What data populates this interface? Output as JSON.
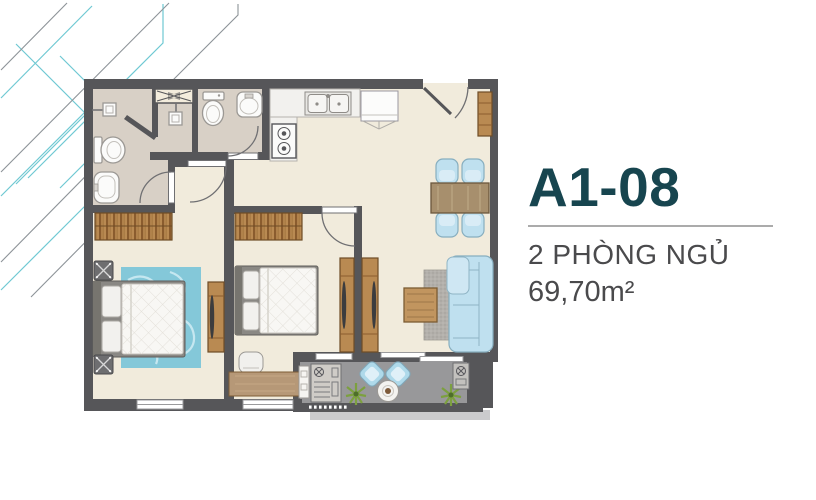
{
  "unit": {
    "code": "A1-08",
    "bedrooms_label": "2 PHÒNG NGỦ",
    "area_label": "69,70m²"
  },
  "palette": {
    "accent_teal": "#17454f",
    "text_gray": "#4a4a4c",
    "divider_gray": "#ababab",
    "wall": "#565659",
    "floor_cream": "#f1ebdc",
    "floor_taupe": "#d8d0c6",
    "balcony_floor": "#98989a",
    "slab_gray": "#cbcbcd",
    "wood": "#b98a52",
    "wood_dark": "#6e4c26",
    "fabric_blue": "#bfe0ef",
    "fabric_blue_border": "#87aebf",
    "rug_blue": "#84c8d9",
    "rug_gray": "#b3b0ab",
    "fixture_white": "#fbfbfa",
    "line_gray": "#6f6f72",
    "decor_teal": "#6fc9d3",
    "decor_gray": "#8d9398",
    "plant_green": "#7ca03f"
  }
}
